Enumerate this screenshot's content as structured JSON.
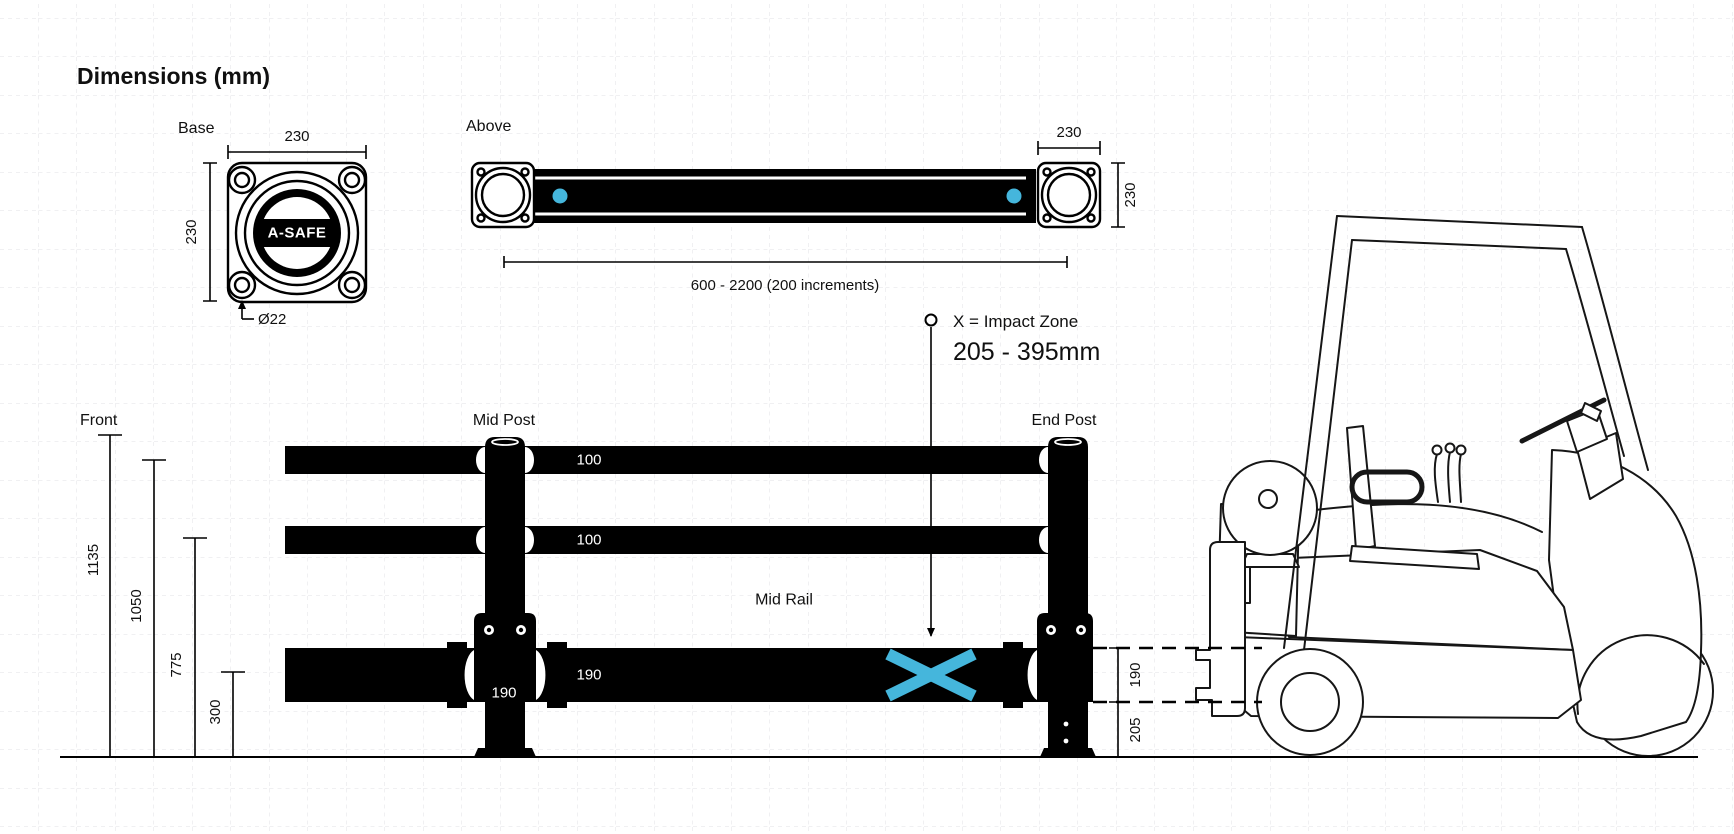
{
  "colors": {
    "accent": "#45b6dc",
    "ink": "#000000",
    "grid": "#e2e2e6"
  },
  "title": "Dimensions (mm)",
  "views": {
    "base": {
      "label": "Base",
      "width": "230",
      "height": "230",
      "hole_dia": "Ø22",
      "logo": "A-SAFE"
    },
    "above": {
      "label": "Above",
      "plate_width": "230",
      "plate_depth": "230",
      "length_range": "600 - 2200 (200 increments)"
    },
    "impact": {
      "title": "X = Impact Zone",
      "range": "205 - 395mm"
    },
    "front": {
      "label": "Front",
      "heights": {
        "overall": "1135",
        "top_rail": "1050",
        "mid_height": "775",
        "bottom": "300"
      },
      "mid_post_label": "Mid Post",
      "end_post_label": "End Post",
      "mid_rail_label": "Mid Rail",
      "top_rail_size": "100",
      "mid_rail_size": "100",
      "bottom_rail_size": "190",
      "post_width": "190",
      "side": {
        "rail_height": "190",
        "ground_clearance": "205"
      }
    }
  }
}
